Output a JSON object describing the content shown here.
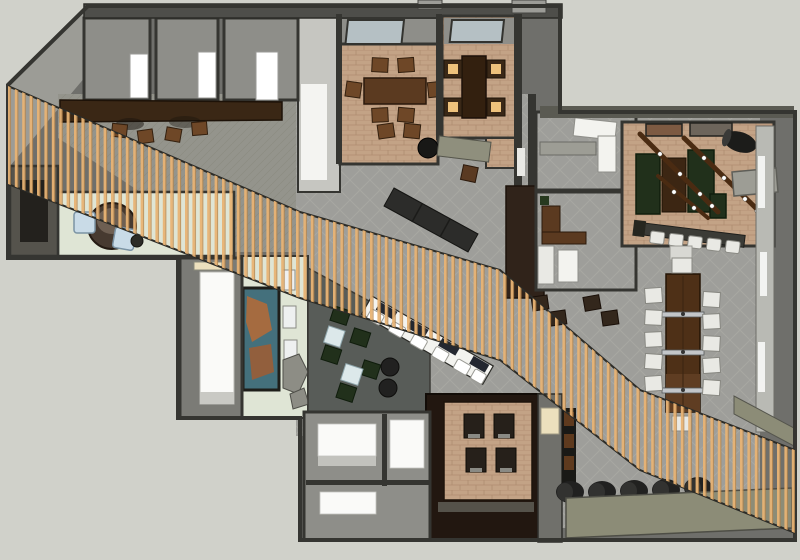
{
  "meta": {
    "type": "3d-floor-plan-render",
    "view": "top-down axonometric",
    "visible_text": "none"
  },
  "palette": {
    "bg": "#d0d1ca",
    "wallFill": "#6f6f6b",
    "wallLine": "#353531",
    "roofWedge": "#9c9c96",
    "roomGray": "#8e8e89",
    "corridor": "#c6c6c1",
    "corridorBright": "#f4f4f1",
    "topWall": "#4e4e4a",
    "tab": "#9c9c97",
    "carpet": "#9e9e9a",
    "carpetLine": "#aeaea8",
    "hatchBase": "#94948c",
    "hatchLine": "#88887f",
    "tan": "#c3a386",
    "tanLine": "#a9876a",
    "skylight": "#b5c0c4",
    "woodTable": "#5b3a20",
    "woodChair": "#6e4727",
    "woodDarkTable": "#33200f",
    "amber": "#eec27c",
    "forestGreen": "#21301b",
    "beam": "#4a2b12",
    "walnutCounter": "#3a2715",
    "walnutTable": "#4e3017",
    "walnutLight": "#5f3d22",
    "espresso": "#221710",
    "boothSeat": "#26201a",
    "paleGreen": "#dfe5d5",
    "annex": "#55534c",
    "annexDoor": "#23211d",
    "deskDark": "#473a30",
    "deskLight": "#6e5f52",
    "lightBlue": "#c9dbe7",
    "cream": "#ece0bd",
    "muralTeal": "#44707c",
    "muralOrange": "#b06a3a",
    "loungeFloor": "#585c58",
    "loungeTable": "#dce8ea",
    "poufDark": "#212120",
    "chairWhite": "#e9e9e4",
    "offWhite": "#f3f3ef",
    "white": "#ffffff",
    "glazing": "#b9bab4",
    "olive": "#8c8c77",
    "counterOlive": "#8f8f7d",
    "shelfGray": "#9d9d95",
    "darkBench": "#2c2c2a",
    "barDark": "#232730",
    "steel": "#c3c6c9",
    "slat": "#e8b374",
    "slatEdge": "#b08048",
    "darkBand": "#30231a",
    "blockFloor": "#fafaf8"
  },
  "scene": {
    "feature": "diagonal timber slat screen crossing plan from top-left to bottom-right",
    "zones": [
      {
        "id": "gray-rooms-top-left",
        "count": 3,
        "floor": "roomGray",
        "note": "white panel in each"
      },
      {
        "id": "meeting-room-a",
        "floor": "tan",
        "table": 1,
        "chairs": 8,
        "skylight": 1
      },
      {
        "id": "meeting-room-b",
        "floor": "tan",
        "table": 1,
        "lit_chairs": 4,
        "skylight": 1
      },
      {
        "id": "reception",
        "floor": "paleGreen",
        "curved_desk": 1,
        "blue_seats": 2,
        "plant": 1
      },
      {
        "id": "gallery-counter",
        "stools": 4
      },
      {
        "id": "white-corridor-block",
        "floor": "blockFloor"
      },
      {
        "id": "mural-wall",
        "benches": 3,
        "rocks": 2
      },
      {
        "id": "lounge",
        "floor": "loungeFloor",
        "green_armchairs": 5,
        "coffee_tables": 2,
        "round_poufs": 2
      },
      {
        "id": "diagonal-bar",
        "stools": 6
      },
      {
        "id": "offices",
        "count": 2
      },
      {
        "id": "game-room",
        "floor": "tan",
        "green_benches": 3,
        "beam_lights": 3,
        "pictures": 2,
        "stool_row": 5
      },
      {
        "id": "communal-table",
        "side_chairs": 10,
        "end_chairs": 2,
        "clamps": 3
      },
      {
        "id": "booth",
        "floor": "tan",
        "seats": 4
      },
      {
        "id": "pouf-row-bottom",
        "poufs": 5
      },
      {
        "id": "bottom-rooms",
        "white_floors": 3
      }
    ]
  }
}
